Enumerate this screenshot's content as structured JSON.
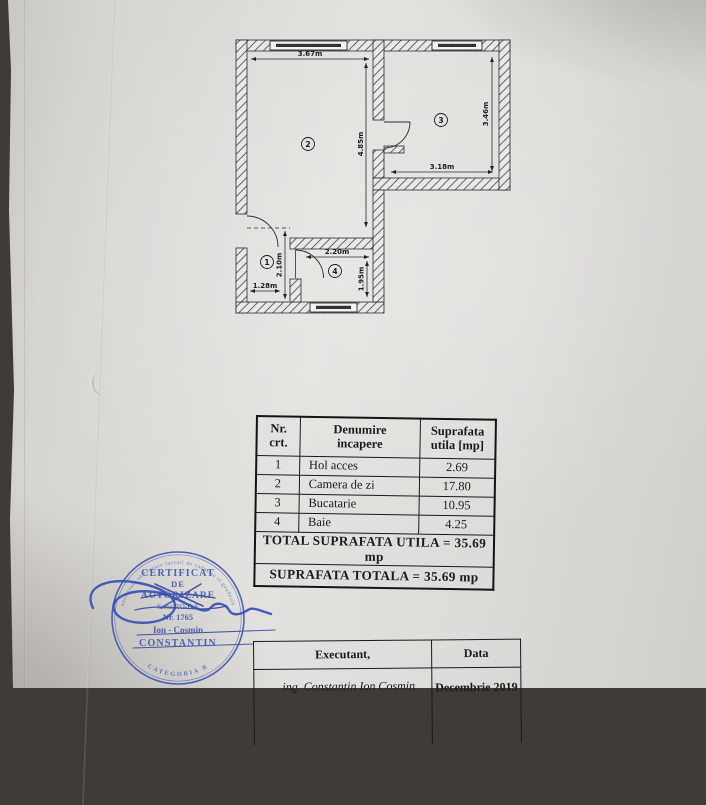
{
  "plan": {
    "room_numbers": [
      "1",
      "2",
      "3",
      "4"
    ],
    "dims": {
      "room2_width": "3.67m",
      "room2_height": "4.85m",
      "room3_width": "3.18m",
      "room3_height": "3.46m",
      "room4_width": "2.20m",
      "room4_height": "1.95m",
      "hall_height": "2.10m",
      "hall_width": "1.28m"
    }
  },
  "area_table": {
    "headers": {
      "col1_line1": "Nr.",
      "col1_line2": "crt.",
      "col2_line1": "Denumire",
      "col2_line2": "incapere",
      "col3_line1": "Suprafata",
      "col3_line2": "utila [mp]"
    },
    "rows": [
      {
        "nr": "1",
        "name": "Hol acces",
        "area": "2.69"
      },
      {
        "nr": "2",
        "name": "Camera de zi",
        "area": "17.80"
      },
      {
        "nr": "3",
        "name": "Bucatarie",
        "area": "10.95"
      },
      {
        "nr": "4",
        "name": "Baie",
        "area": "4.25"
      }
    ],
    "total_utila": "TOTAL SUPRAFATA UTILA = 35.69 mp",
    "total_totala": "SUPRAFATA TOTALA = 35.69 mp"
  },
  "stamp": {
    "ring_top": "autorizata sa execute lucrari de cadastru si geodezie",
    "line1": "CERTIFICAT",
    "line2": "DE",
    "line3": "AUTORIZARE",
    "line4": "Seria RO-B-F",
    "line5": "Nr. 1765",
    "line6": "Ion - Cosmin",
    "line7": "CONSTANTIN",
    "ring_bottom": "CATEGORIA B",
    "ink_color": "#3b53b2"
  },
  "footer_table": {
    "executant_label": "Executant,",
    "data_label": "Data",
    "executant_value": "ing. Constantin Ion Cosmin",
    "data_value": "Decembrie 2019"
  }
}
